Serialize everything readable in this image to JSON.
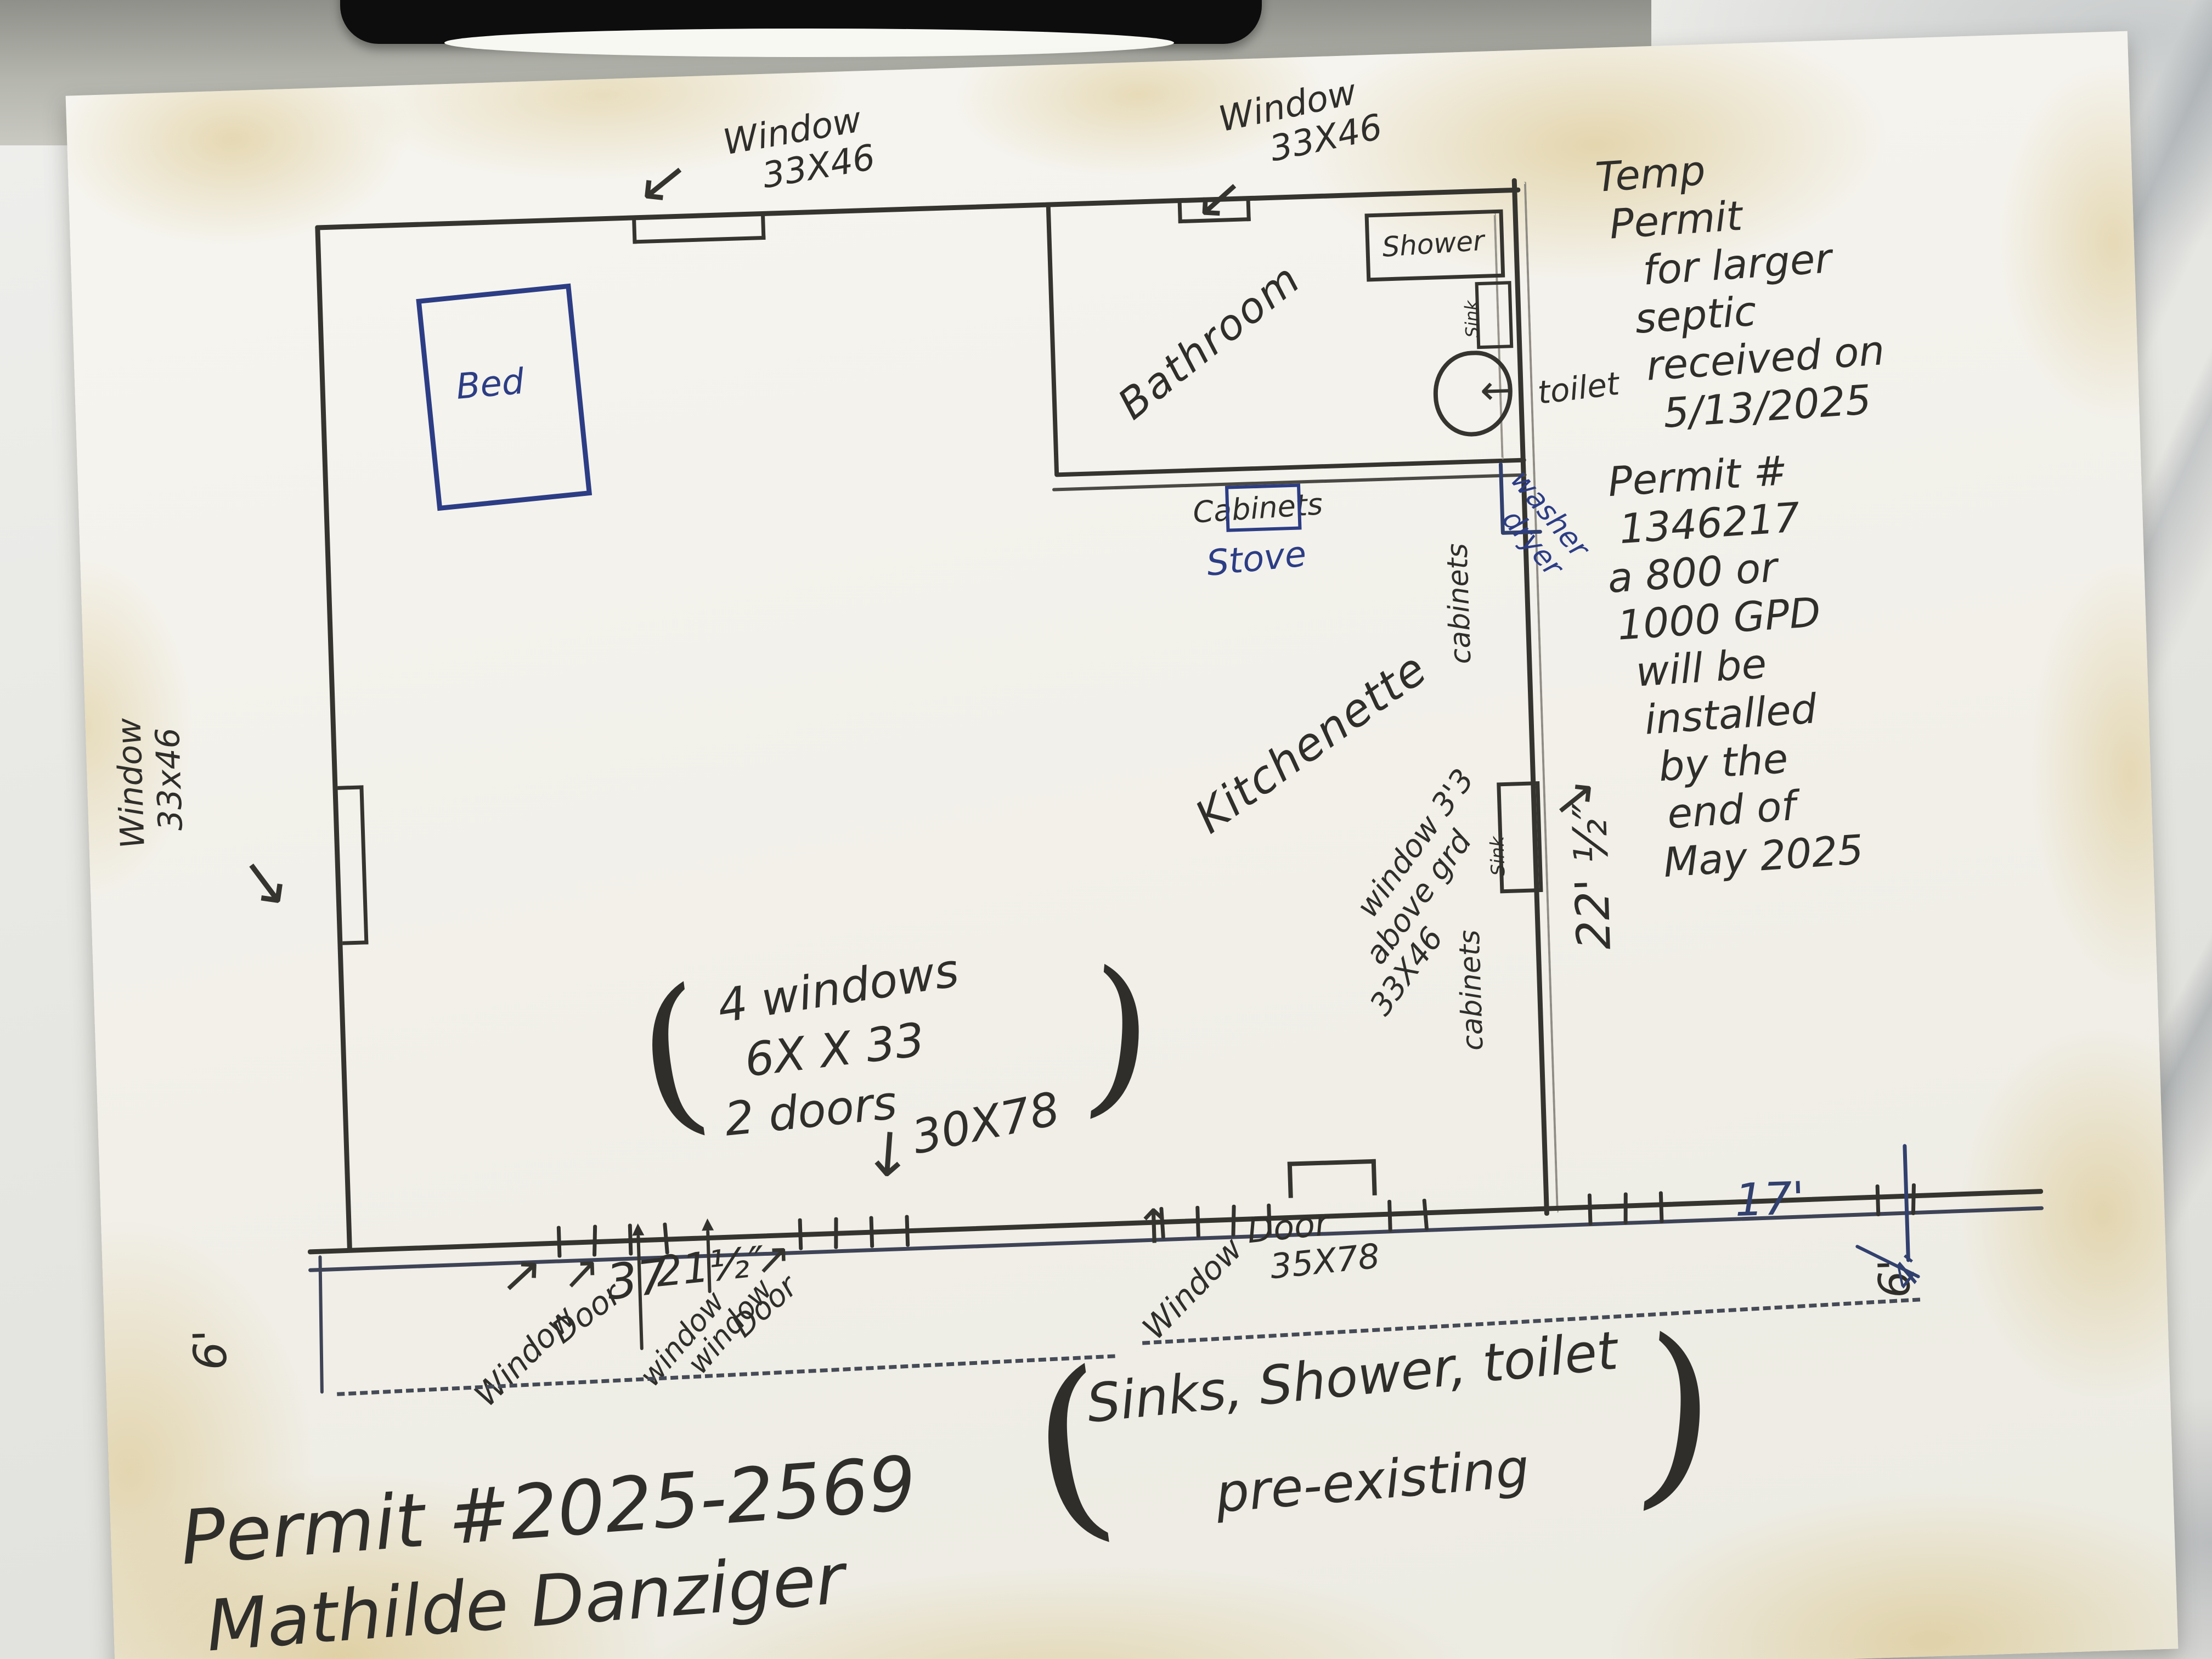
{
  "notes": {
    "temp_permit": {
      "lines": [
        "Temp",
        "Permit",
        "for larger",
        "septic",
        "received on",
        "5/13/2025"
      ]
    },
    "septic_install": {
      "lines": [
        "Permit #",
        "1346217",
        "a 800 or",
        "1000 GPD",
        "will be",
        "installed",
        "by the",
        "end of",
        "May 2025"
      ]
    },
    "preexisting": {
      "paren_open": "(",
      "line1": "Sinks, Shower, toilet",
      "line2": "pre-existing",
      "paren_close": ")"
    },
    "permit_id": "Permit #2025-2569",
    "owner": "Mathilde Danziger"
  },
  "plan": {
    "rooms": {
      "bathroom": "Bathroom",
      "kitchenette": "Kitchenette",
      "bed": "Bed"
    },
    "fixtures": {
      "shower": "Shower",
      "bath_sink": "Sink",
      "toilet": "toilet",
      "cabinets": "Cabinets",
      "stove": "Stove",
      "washer": "washer",
      "dryer": "dryer",
      "cabinets_side_upper": "cabinets",
      "cabinets_side_lower": "cabinets",
      "kitchen_sink": "Sink"
    },
    "windows": {
      "top_left": {
        "line1": "Window",
        "line2": "33X46"
      },
      "top_right": {
        "line1": "Window",
        "line2": "33X46"
      },
      "left": {
        "line1": "Window",
        "line2": "33x46"
      },
      "kitchen_note": {
        "line1": "window 3'3",
        "line2": "above grd",
        "line3": "33X46"
      }
    },
    "center_note": {
      "paren_open": "(",
      "line1": "4 windows",
      "line2": "6X X 33",
      "line3": "2 doors",
      "line4": "30X78",
      "paren_close": ")"
    },
    "bottom": {
      "window1": "Window",
      "door1": "Door",
      "dim1": "37",
      "dim2": "21½″",
      "window2": "window",
      "window3": "window",
      "door2": "Door",
      "window4": "Window",
      "door3_line1": "Door",
      "door3_line2": "35X78",
      "dim17": "17'"
    },
    "dims": {
      "right_wall": "22' ½″",
      "porch_left": "6'",
      "porch_right": "6'",
      "porch_corner": "4'"
    }
  }
}
